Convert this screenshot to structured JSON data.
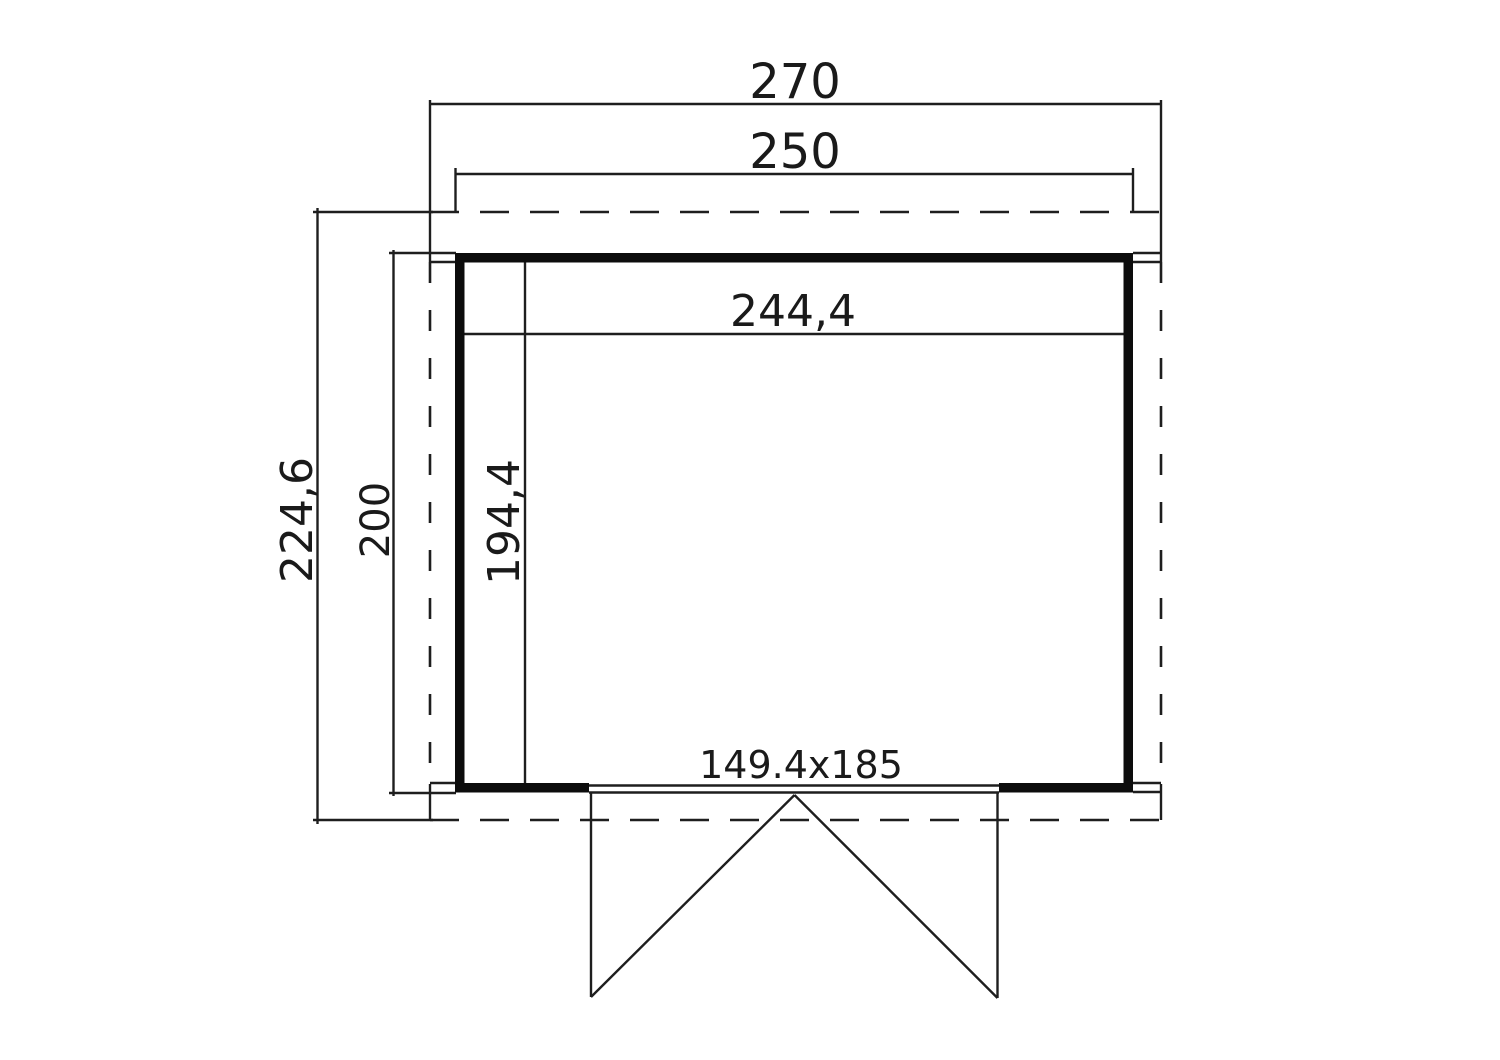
{
  "plan": {
    "dimensions": {
      "roof_width": "270",
      "outer_width": "250",
      "inner_width": "244,4",
      "roof_depth": "224,6",
      "outer_depth": "200",
      "inner_depth": "194,4",
      "door_size": "149.4x185"
    },
    "colors": {
      "line": "#1e1e1e",
      "wall": "#0c0c0c",
      "background": "#ffffff"
    }
  }
}
